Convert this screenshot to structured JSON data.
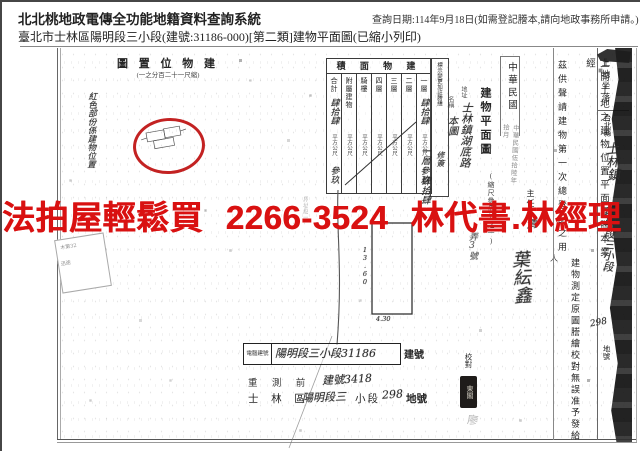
{
  "header": {
    "system_title": "北北桃地政電傳全功能地籍資料查詢系統",
    "query_note": "查詢日期:114年9月18日(如需登記謄本,請向地政事務所申請。)",
    "subject_line": "臺北市士林區陽明段三小段(建號:31186-000)[第二類]建物平面圖(已縮小列印)"
  },
  "watermark": {
    "text": "法拍屋輕鬆買 2266-3524 林代書.林經理",
    "color": "#d91111"
  },
  "location_map": {
    "title": "圖 置 位 物 建",
    "scale_note": "(一之分百二十一尺縮)",
    "side_note": "紅色部份係建物位置"
  },
  "area_table": {
    "title": "積 面 物 建",
    "unit": "平方公尺",
    "columns": [
      {
        "label": "合計",
        "value_top": "肆拾肆",
        "value_bottom": "參玖"
      },
      {
        "label": "附屬建物",
        "value_top": "",
        "value_bottom": ""
      },
      {
        "label": "騎樓",
        "value_top": "",
        "value_bottom": ""
      },
      {
        "label": "四層",
        "value_top": "",
        "value_bottom": ""
      },
      {
        "label": "三層",
        "value_top": "",
        "value_bottom": ""
      },
      {
        "label": "二層",
        "value_top": "",
        "value_bottom": ""
      },
      {
        "label": "一層",
        "value_top": "肆拾肆",
        "value_bottom": "參玖"
      }
    ]
  },
  "annotations": {
    "change_box_label": "標示變更加註謄繕",
    "change_box_note": "修簽",
    "first_floor_note": "一層:肆拾肆",
    "name_label": "名稱",
    "name_value": "本圖",
    "addr_label": "地址",
    "addr_value": "士林鎮湖底路",
    "addr_tail": "弄3號"
  },
  "floor_plan": {
    "title": "建物平面圖",
    "scale_note": "(縮尺參佰分之一)",
    "dim_left": "13.60",
    "dim_bottom": "4.30",
    "margin_note": "界址點一"
  },
  "certification": {
    "roc_label": "中華民國",
    "date_stamp": "中華民國伍拾陸年拾月",
    "purpose_text": "茲供聲請建物第一次總登記之用",
    "statement_part1": "上開土地之建物位置平面圖謄本業經",
    "statement_part2": "建物測定原圖謄繪校對無誤准予發給",
    "chief_label": "主任",
    "chief_sig": "清",
    "signature": "葉紜鑫",
    "person_label": "人",
    "proofread_label": "校對",
    "seal_text": "東閣",
    "faint_stamp": "廖",
    "land_location_label": "土地坐落",
    "county": "台北縣",
    "town_hw": "士林鎮",
    "section_hw": "陽明段三小段",
    "parcel_hw": "298",
    "parcel_label": "地號"
  },
  "footer": {
    "box_prefix": "電腦建號",
    "box_value": "陽明段三小段31186",
    "box_suffix": "建號",
    "resurvey_label": "重 測 前",
    "resurvey_value": "建號3418",
    "line3_p1": "士 林 區",
    "line3_hw1": "陽明段三",
    "line3_p2": "小段",
    "line3_hw2": "298",
    "line3_p3": "地號"
  },
  "blob": {
    "line1": "木第32",
    "line2": "迅途"
  }
}
